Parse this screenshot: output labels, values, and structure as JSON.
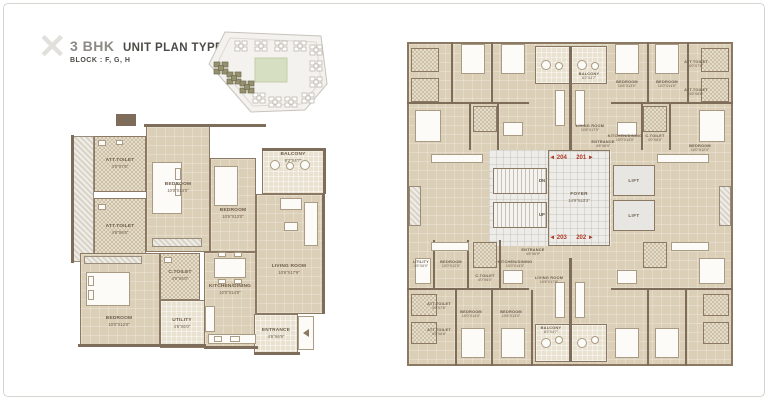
{
  "header": {
    "logo_glyph": "✕",
    "title_prefix": "3 BHK",
    "title_rest": "UNIT PLAN TYPE - 3",
    "block_line": "BLOCK : F, G, H"
  },
  "colors": {
    "floor": "#dccfb8",
    "wall": "#7e6d5a",
    "accent_red": "#b03a28",
    "balcony_floor": "#e9e2d1",
    "keyplan_highlight": "#95916f"
  },
  "left_plan": {
    "rooms": {
      "att_toilet_1": {
        "name": "ATT.TOILET",
        "dim": "4'0\"X7'6\""
      },
      "att_toilet_2": {
        "name": "ATT.TOILET",
        "dim": "4'6\"X6'6\""
      },
      "bedroom_master": {
        "name": "BEDROOM",
        "dim": "10'0\"X14'0\""
      },
      "bedroom_2": {
        "name": "BEDROOM",
        "dim": "10'6\"X13'0\""
      },
      "balcony": {
        "name": "BALCONY",
        "dim": "8'2\"X4'7\""
      },
      "living": {
        "name": "LIVING ROOM",
        "dim": "10'6\"X17'9\""
      },
      "kitchen": {
        "name": "KITCHEN/DINING",
        "dim": "10'0\"X14'0\""
      },
      "bedroom_3": {
        "name": "BEDROOM",
        "dim": "10'0\"X12'0\""
      },
      "c_toilet": {
        "name": "C.TOILET",
        "dim": "4'0\"X6'0\""
      },
      "utility": {
        "name": "UTILITY",
        "dim": "4'6\"X6'0\""
      },
      "entrance": {
        "name": "ENTRANCE",
        "dim": "4'6\"X6'9\""
      }
    }
  },
  "right_plan": {
    "core": {
      "foyer": {
        "name": "FOYER",
        "dim": "14'9\"X23'3\""
      },
      "lift": "LIFT",
      "up": "UP",
      "dn": "DN",
      "markers": {
        "m204": "◄ 204",
        "m201": "201 ►",
        "m203": "◄ 203",
        "m202": "202 ►"
      },
      "entrance_top": {
        "name": "ENTRANCE",
        "dim": "4'6\"X6'9\""
      },
      "entrance_bottom": {
        "name": "ENTRANCE",
        "dim": "4'6\"X6'9\""
      }
    },
    "unit201": {
      "balcony": {
        "name": "BALCONY",
        "dim": "8'2\"X4'7\""
      },
      "living": {
        "name": "LIVING ROOM",
        "dim": "10'6\"X17'9\""
      },
      "bedroom_a": {
        "name": "BEDROOM",
        "dim": "10'6\"X13'0\""
      },
      "bedroom_b": {
        "name": "BEDROOM",
        "dim": "10'0\"X14'0\""
      },
      "att_toilet_1": {
        "name": "ATT.TOILET",
        "dim": "4'0\"X7'6\""
      },
      "att_toilet_2": {
        "name": "ATT.TOILET",
        "dim": "4'6\"X6'6\""
      },
      "bedroom_c": {
        "name": "BEDROOM",
        "dim": "10'0\"X12'0\""
      },
      "kitchen": {
        "name": "KITCHEN/DINING",
        "dim": "10'0\"X14'0\""
      },
      "c_toilet": {
        "name": "C.TOILET",
        "dim": "4'0\"X6'0\""
      }
    },
    "unit203": {
      "utility": {
        "name": "UTILITY",
        "dim": "4'6\"X6'0\""
      },
      "bedroom_c": {
        "name": "BEDROOM",
        "dim": "10'0\"X12'0\""
      },
      "c_toilet": {
        "name": "C.TOILET",
        "dim": "4'0\"X6'0\""
      },
      "kitchen": {
        "name": "KITCHEN/DINING",
        "dim": "10'0\"X14'0\""
      },
      "living": {
        "name": "LIVING ROOM",
        "dim": "10'6\"X17'9\""
      },
      "att_toilet_1": {
        "name": "ATT.TOILET",
        "dim": "4'0\"X7'6\""
      },
      "att_toilet_2": {
        "name": "ATT.TOILET",
        "dim": "4'6\"X6'6\""
      },
      "bedroom_d": {
        "name": "BEDROOM",
        "dim": "10'0\"X14'0\""
      },
      "bedroom_e": {
        "name": "BEDROOM",
        "dim": "10'6\"X13'0\""
      },
      "balcony": {
        "name": "BALCONY",
        "dim": "8'2\"X4'7\""
      }
    }
  }
}
